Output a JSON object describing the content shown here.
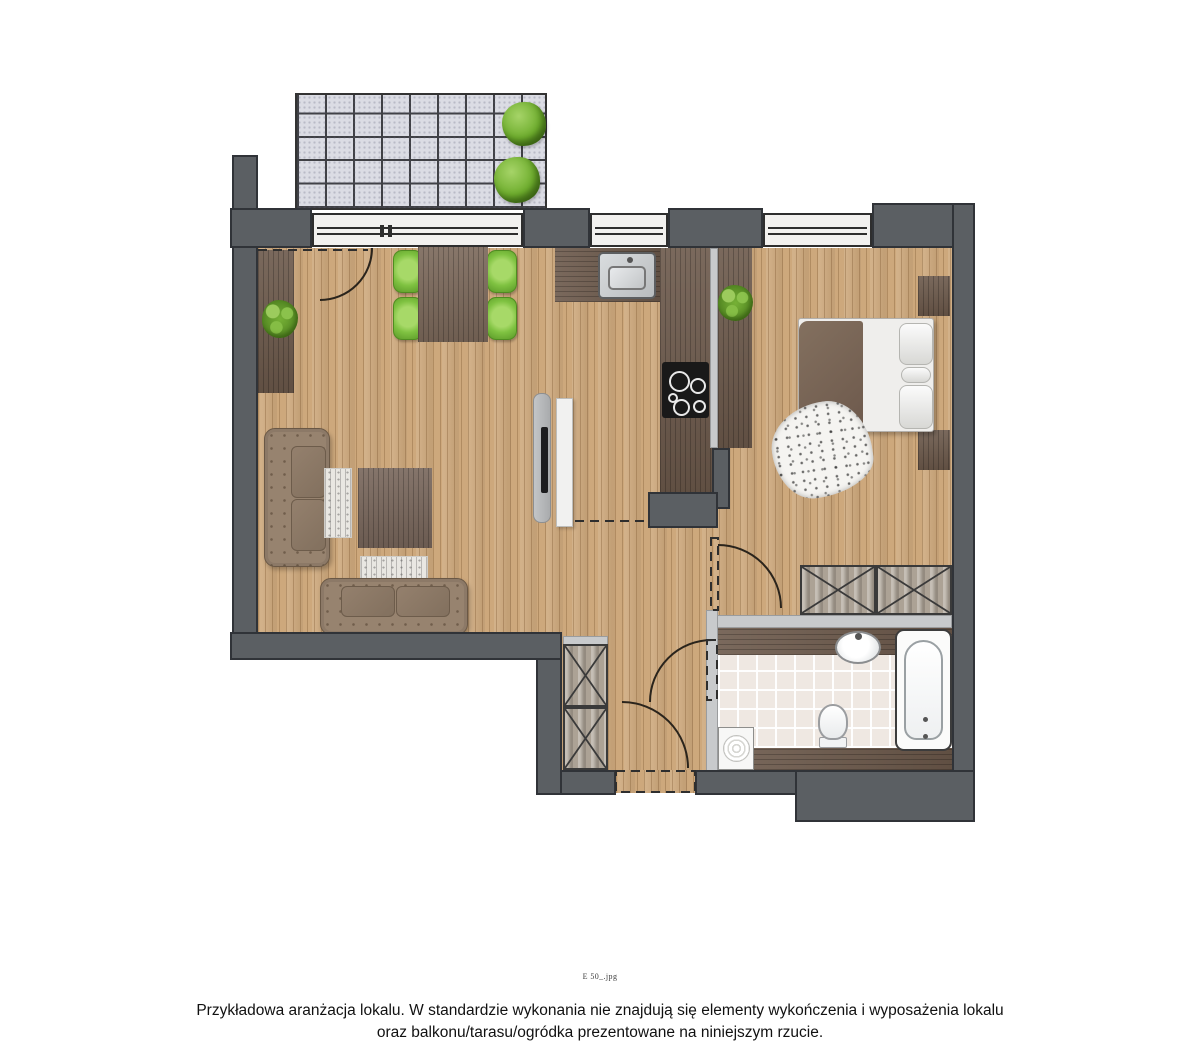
{
  "footer": {
    "filename_note": "E 50_.jpg",
    "caption_line1": "Przykładowa aranżacja lokalu. W standardzie wykonania nie znajdują się elementy wykończenia i wyposażenia lokalu",
    "caption_line2": "oraz balkonu/tarasu/ogródka prezentowane na niniejszym rzucie."
  },
  "colors": {
    "wall_dark": "#5b5f63",
    "wall_light": "#c8cacc",
    "wood_floor": "#cda87c",
    "dark_wood_furniture": "#6b584a",
    "terrace_tile": "#dbdce4",
    "plant_green": "#6fae2e",
    "chair_green": "#7fc241",
    "sofa_brown": "#97836f",
    "bed_blanket_brown": "#6d594c",
    "bathroom_tile": "#efe8e2",
    "fixture_white": "#fbfbfa",
    "outline": "#333333"
  },
  "floorplan": {
    "type": "apartment-floor-plan-top-view",
    "areas": [
      "terrace",
      "living-room-with-dining-area",
      "kitchenette",
      "bedroom-area",
      "hallway",
      "bathroom"
    ],
    "terrace": {
      "tile_columns": 9,
      "tile_rows": 5,
      "plants": 2
    },
    "living_dining": {
      "furniture": [
        "sideboard",
        "potted-plant",
        "dining-table",
        "dining-chair-x4",
        "sofa-large",
        "sofa-small",
        "coffee-table",
        "rug-x2",
        "tv-media-panel"
      ]
    },
    "kitchen": {
      "furniture": [
        "l-shaped-countertop",
        "sink",
        "cooktop",
        "potted-plant"
      ]
    },
    "bedroom_area": {
      "furniture": [
        "double-bed",
        "nightstand-x2",
        "cowhide-rug",
        "wardrobe-2-sections",
        "side-cabinet"
      ]
    },
    "hallway": {
      "furniture": [
        "closet-2-sections"
      ],
      "doors": [
        "entrance-door",
        "bathroom-door",
        "bedroom-door",
        "balcony-door"
      ]
    },
    "bathroom": {
      "furniture": [
        "washbasin-on-counter",
        "bathtub",
        "toilet",
        "washing-machine"
      ]
    },
    "window_count": 3
  }
}
